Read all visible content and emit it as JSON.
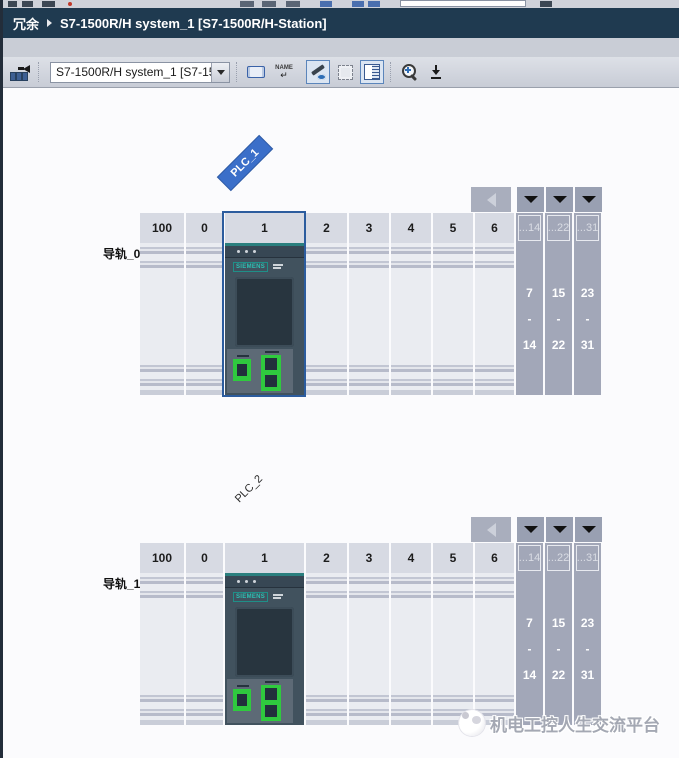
{
  "breadcrumb": {
    "root": "冗余",
    "title": "S7-1500R/H system_1 [S7-1500R/H-Station]"
  },
  "toolbar": {
    "device_select_value": "S7-1500R/H system_1 [S7-150",
    "rename_label": "NAME",
    "rename_return_glyph": "↵"
  },
  "rails": [
    {
      "plc_label": "PLC_1",
      "rail_label": "导轨_0",
      "selected_slot": "1",
      "slots": [
        "100",
        "0",
        "1",
        "2",
        "3",
        "4",
        "5",
        "6"
      ],
      "groups": [
        {
          "header": "...14",
          "from": "7",
          "sep": "-",
          "to": "14"
        },
        {
          "header": "...22",
          "from": "15",
          "sep": "-",
          "to": "22"
        },
        {
          "header": "...31",
          "from": "23",
          "sep": "-",
          "to": "31"
        }
      ],
      "device": {
        "brand": "SIEMENS"
      }
    },
    {
      "plc_label": "PLC_2",
      "rail_label": "导轨_1",
      "selected_slot": "",
      "slots": [
        "100",
        "0",
        "1",
        "2",
        "3",
        "4",
        "5",
        "6"
      ],
      "groups": [
        {
          "header": "...14",
          "from": "7",
          "sep": "-",
          "to": "14"
        },
        {
          "header": "...22",
          "from": "15",
          "sep": "-",
          "to": "22"
        },
        {
          "header": "...31",
          "from": "23",
          "sep": "-",
          "to": "31"
        }
      ],
      "device": {
        "brand": "SIEMENS"
      }
    }
  ],
  "watermark": {
    "text": "机电工控人生交流平台"
  },
  "colors": {
    "breadcrumb_bg": "#1f3a50",
    "selection_blue": "#2c5c9e",
    "plc_badge_blue": "#3b6fc9",
    "siemens_teal": "#2cc0b4",
    "port_green": "#2fca3e",
    "collapsed_gray": "#a2a7b8"
  }
}
